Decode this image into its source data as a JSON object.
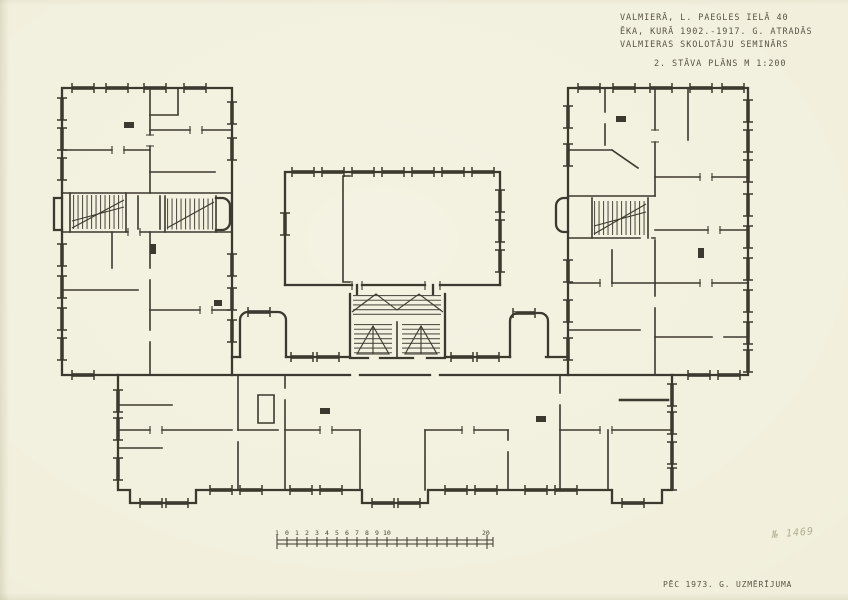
{
  "sheet": {
    "paper_color": "#f1efdb",
    "ink_color": "#3c392f"
  },
  "title_block": {
    "line1": "VALMIERĀ, L. PAEGLES IELĀ 40",
    "line2": "ĒKA, KURĀ 1902.-1917. G. ATRADĀS",
    "line3": "VALMIERAS SKOLOTĀJU SEMINĀRS",
    "line4": "2. STĀVA PLĀNS  M 1:200"
  },
  "footer": {
    "survey_note": "PĒC 1973. G. UZMĒRĪJUMA"
  },
  "annotations": {
    "inventory_number": "№ 1469"
  },
  "scale_bar": {
    "labels": [
      "1",
      "0",
      "1",
      "2",
      "3",
      "4",
      "5",
      "6",
      "7",
      "8",
      "9",
      "10",
      "20"
    ]
  }
}
